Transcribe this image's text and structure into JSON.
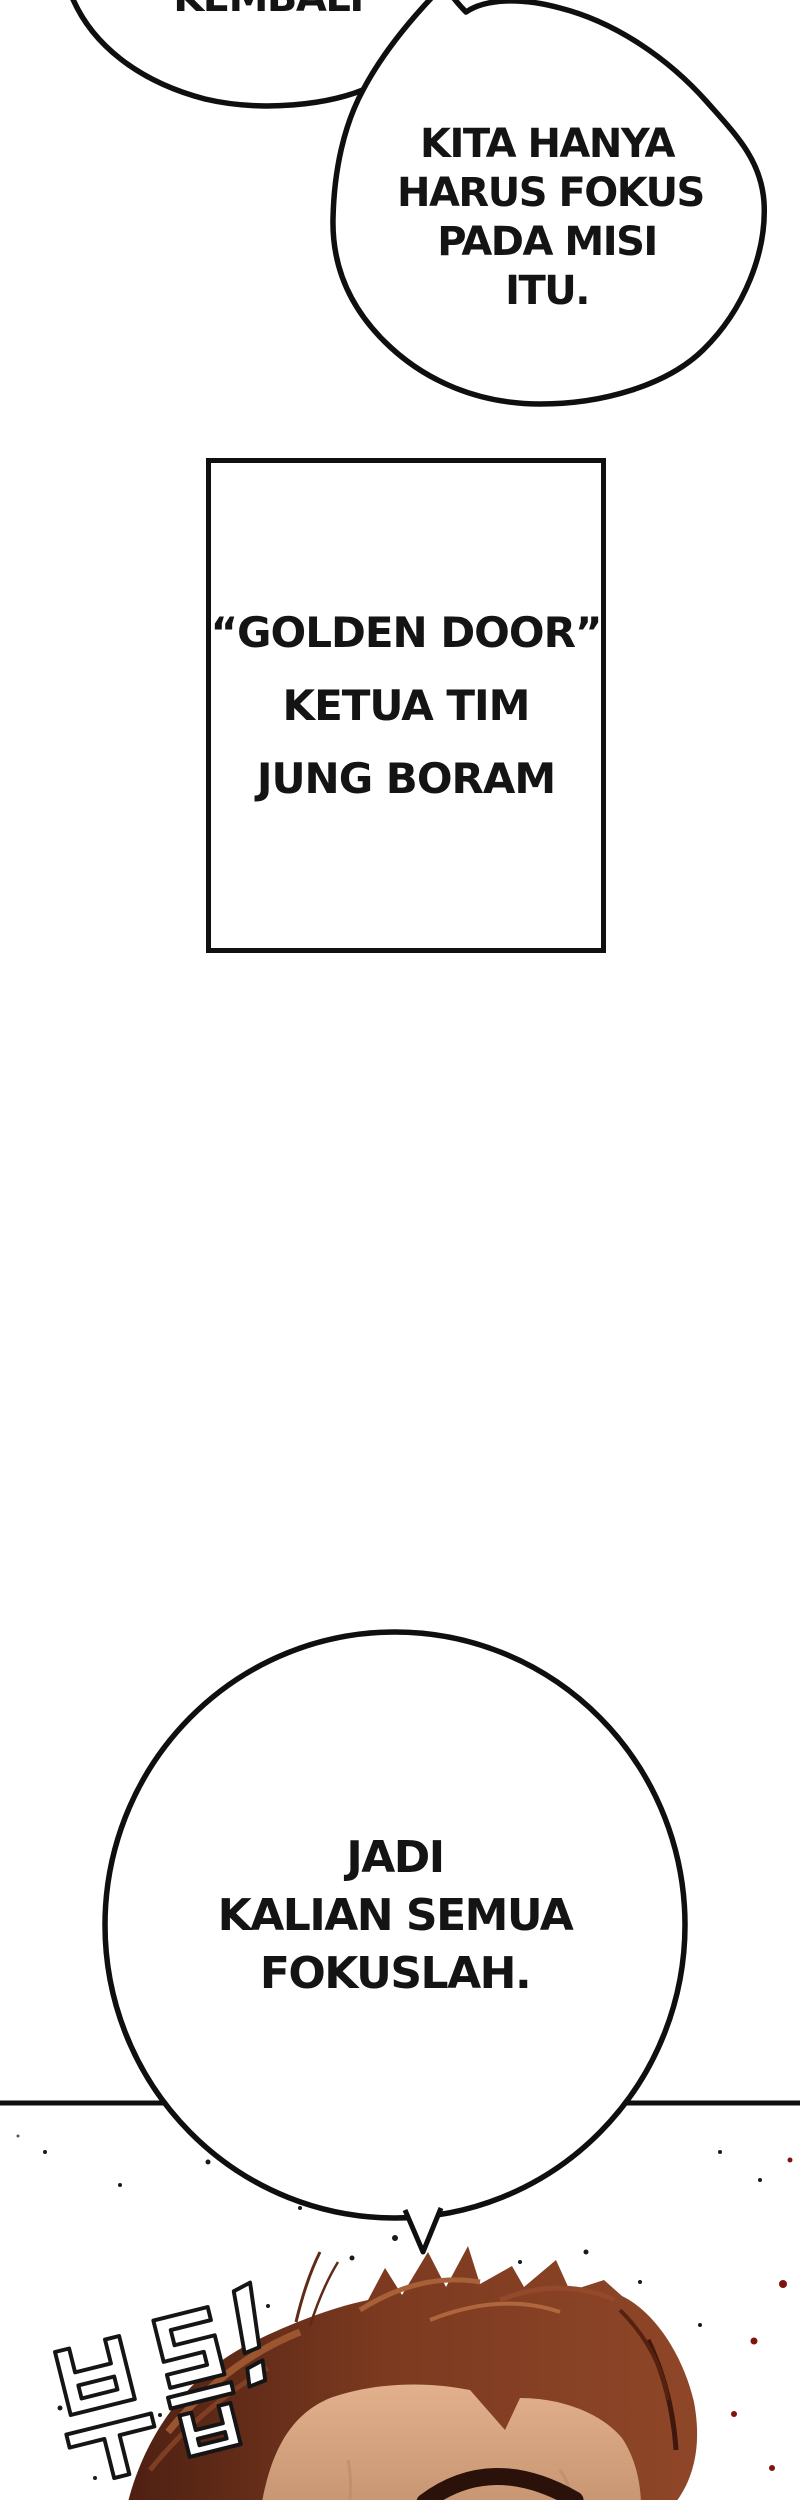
{
  "page": {
    "width": 800,
    "height": 2500,
    "bg": "#ffffff",
    "ink": "#0f0f0f"
  },
  "speech_bubbles": {
    "partial_top": {
      "text": "KEMBALI"
    },
    "mission": {
      "lines": [
        "KITA HANYA",
        "HARUS FOKUS",
        "PADA MISI",
        "ITU."
      ]
    },
    "focus": {
      "lines": [
        "JADI",
        "KALIAN SEMUA",
        "FOKUSLAH."
      ]
    }
  },
  "caption_box": {
    "lines": [
      "“GOLDEN DOOR”",
      "KETUA TIM",
      "JUNG BORAM"
    ]
  },
  "sfx": {
    "text": "부릅!"
  },
  "artwork": {
    "colors": {
      "hair_dark": "#4e2012",
      "hair_mid": "#7c3a20",
      "hair_light": "#a86038",
      "hair_highlight": "#c07848",
      "skin": "#e2b08c",
      "skin_shadow": "#c08b66",
      "eyebrow": "#2a120b",
      "blood_speck": "#7d150c",
      "ink": "#0f0f0f"
    }
  }
}
